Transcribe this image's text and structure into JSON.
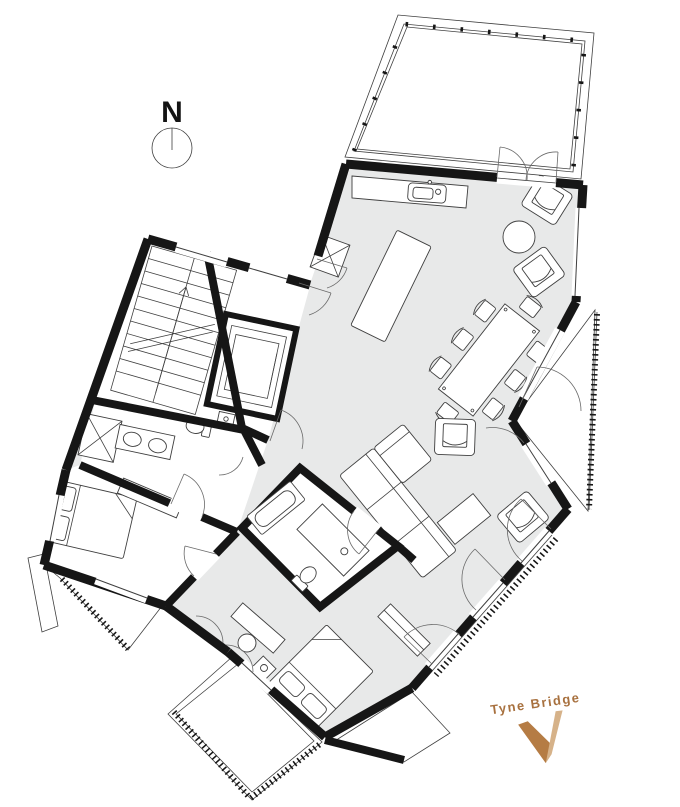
{
  "compass": {
    "label": "N"
  },
  "annotation": {
    "label": "Tyne Bridge"
  },
  "palette": {
    "paper": "#ffffff",
    "wall": "#161616",
    "line": "#3f3f3f",
    "floor": "#e8e9e9",
    "accent": "#a8713f",
    "accent_dark": "#b57c44",
    "accent_light": "#d6b289"
  },
  "icons": {
    "north_arrow_icon": "circle with N and meridian line",
    "direction_v_icon": "two-tone V chevron pointing toward bridge"
  }
}
